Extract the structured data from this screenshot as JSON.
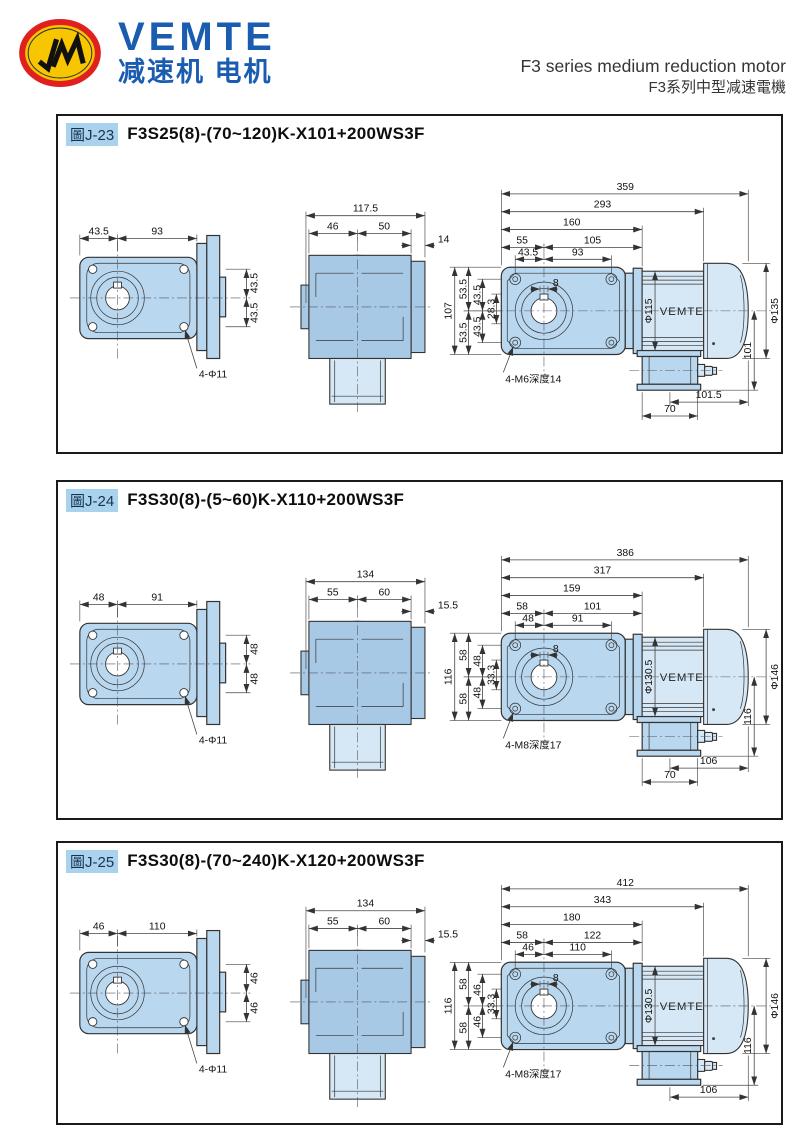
{
  "header": {
    "brand": "VEMTE",
    "brand_sub": "减速机 电机",
    "title_en": "F3 series medium reduction motor",
    "title_zh": "F3系列中型减速電機"
  },
  "panels": [
    {
      "tag": "圖J-23",
      "title": "F3S25(8)-(70~120)K-X101+200WS3F",
      "front": {
        "w1": "43.5",
        "w2": "93",
        "h1": "43.5",
        "h2": "43.5",
        "holes": "4-Φ11"
      },
      "side": {
        "total": "117.5",
        "left": "46",
        "right": "50",
        "flange": "14"
      },
      "heights": {
        "total": "107",
        "top": "53.5",
        "bottom": "53.5",
        "inner_top": "43.5",
        "inner_bottom": "43.5",
        "key_depth": "28.3"
      },
      "section": {
        "len_total": "359",
        "len_body": "293",
        "len_gear": "160",
        "a": "55",
        "b": "105",
        "c": "43.5",
        "d": "93",
        "key_w": "8",
        "tap": "4-M6深度14",
        "motor_dia": "Φ115",
        "brand": "VEMTE",
        "cap_dia": "Φ135",
        "cap_h": "101",
        "bottom_a": "101.5",
        "bottom_b": "70"
      }
    },
    {
      "tag": "圖J-24",
      "title": "F3S30(8)-(5~60)K-X110+200WS3F",
      "front": {
        "w1": "48",
        "w2": "91",
        "h1": "48",
        "h2": "48",
        "holes": "4-Φ11"
      },
      "side": {
        "total": "134",
        "left": "55",
        "right": "60",
        "flange": "15.5"
      },
      "heights": {
        "total": "116",
        "top": "58",
        "bottom": "58",
        "inner_top": "48",
        "inner_bottom": "48",
        "key_depth": "33.3"
      },
      "section": {
        "len_total": "386",
        "len_body": "317",
        "len_gear": "159",
        "a": "58",
        "b": "101",
        "c": "48",
        "d": "91",
        "key_w": "8",
        "tap": "4-M8深度17",
        "motor_dia": "Φ130.5",
        "brand": "VEMTE",
        "cap_dia": "Φ146",
        "cap_h": "116",
        "bottom_a": "106",
        "bottom_b": "70"
      }
    },
    {
      "tag": "圖J-25",
      "title": "F3S30(8)-(70~240)K-X120+200WS3F",
      "front": {
        "w1": "46",
        "w2": "110",
        "h1": "46",
        "h2": "46",
        "holes": "4-Φ11"
      },
      "side": {
        "total": "134",
        "left": "55",
        "right": "60",
        "flange": "15.5"
      },
      "heights": {
        "total": "116",
        "top": "58",
        "bottom": "58",
        "inner_top": "46",
        "inner_bottom": "46",
        "key_depth": "33.3"
      },
      "section": {
        "len_total": "412",
        "len_body": "343",
        "len_gear": "180",
        "a": "58",
        "b": "122",
        "c": "46",
        "d": "110",
        "key_w": "8",
        "tap": "4-M8深度17",
        "motor_dia": "Φ130.5",
        "brand": "VEMTE",
        "cap_dia": "Φ146",
        "cap_h": "116",
        "bottom_a": "106"
      }
    }
  ]
}
